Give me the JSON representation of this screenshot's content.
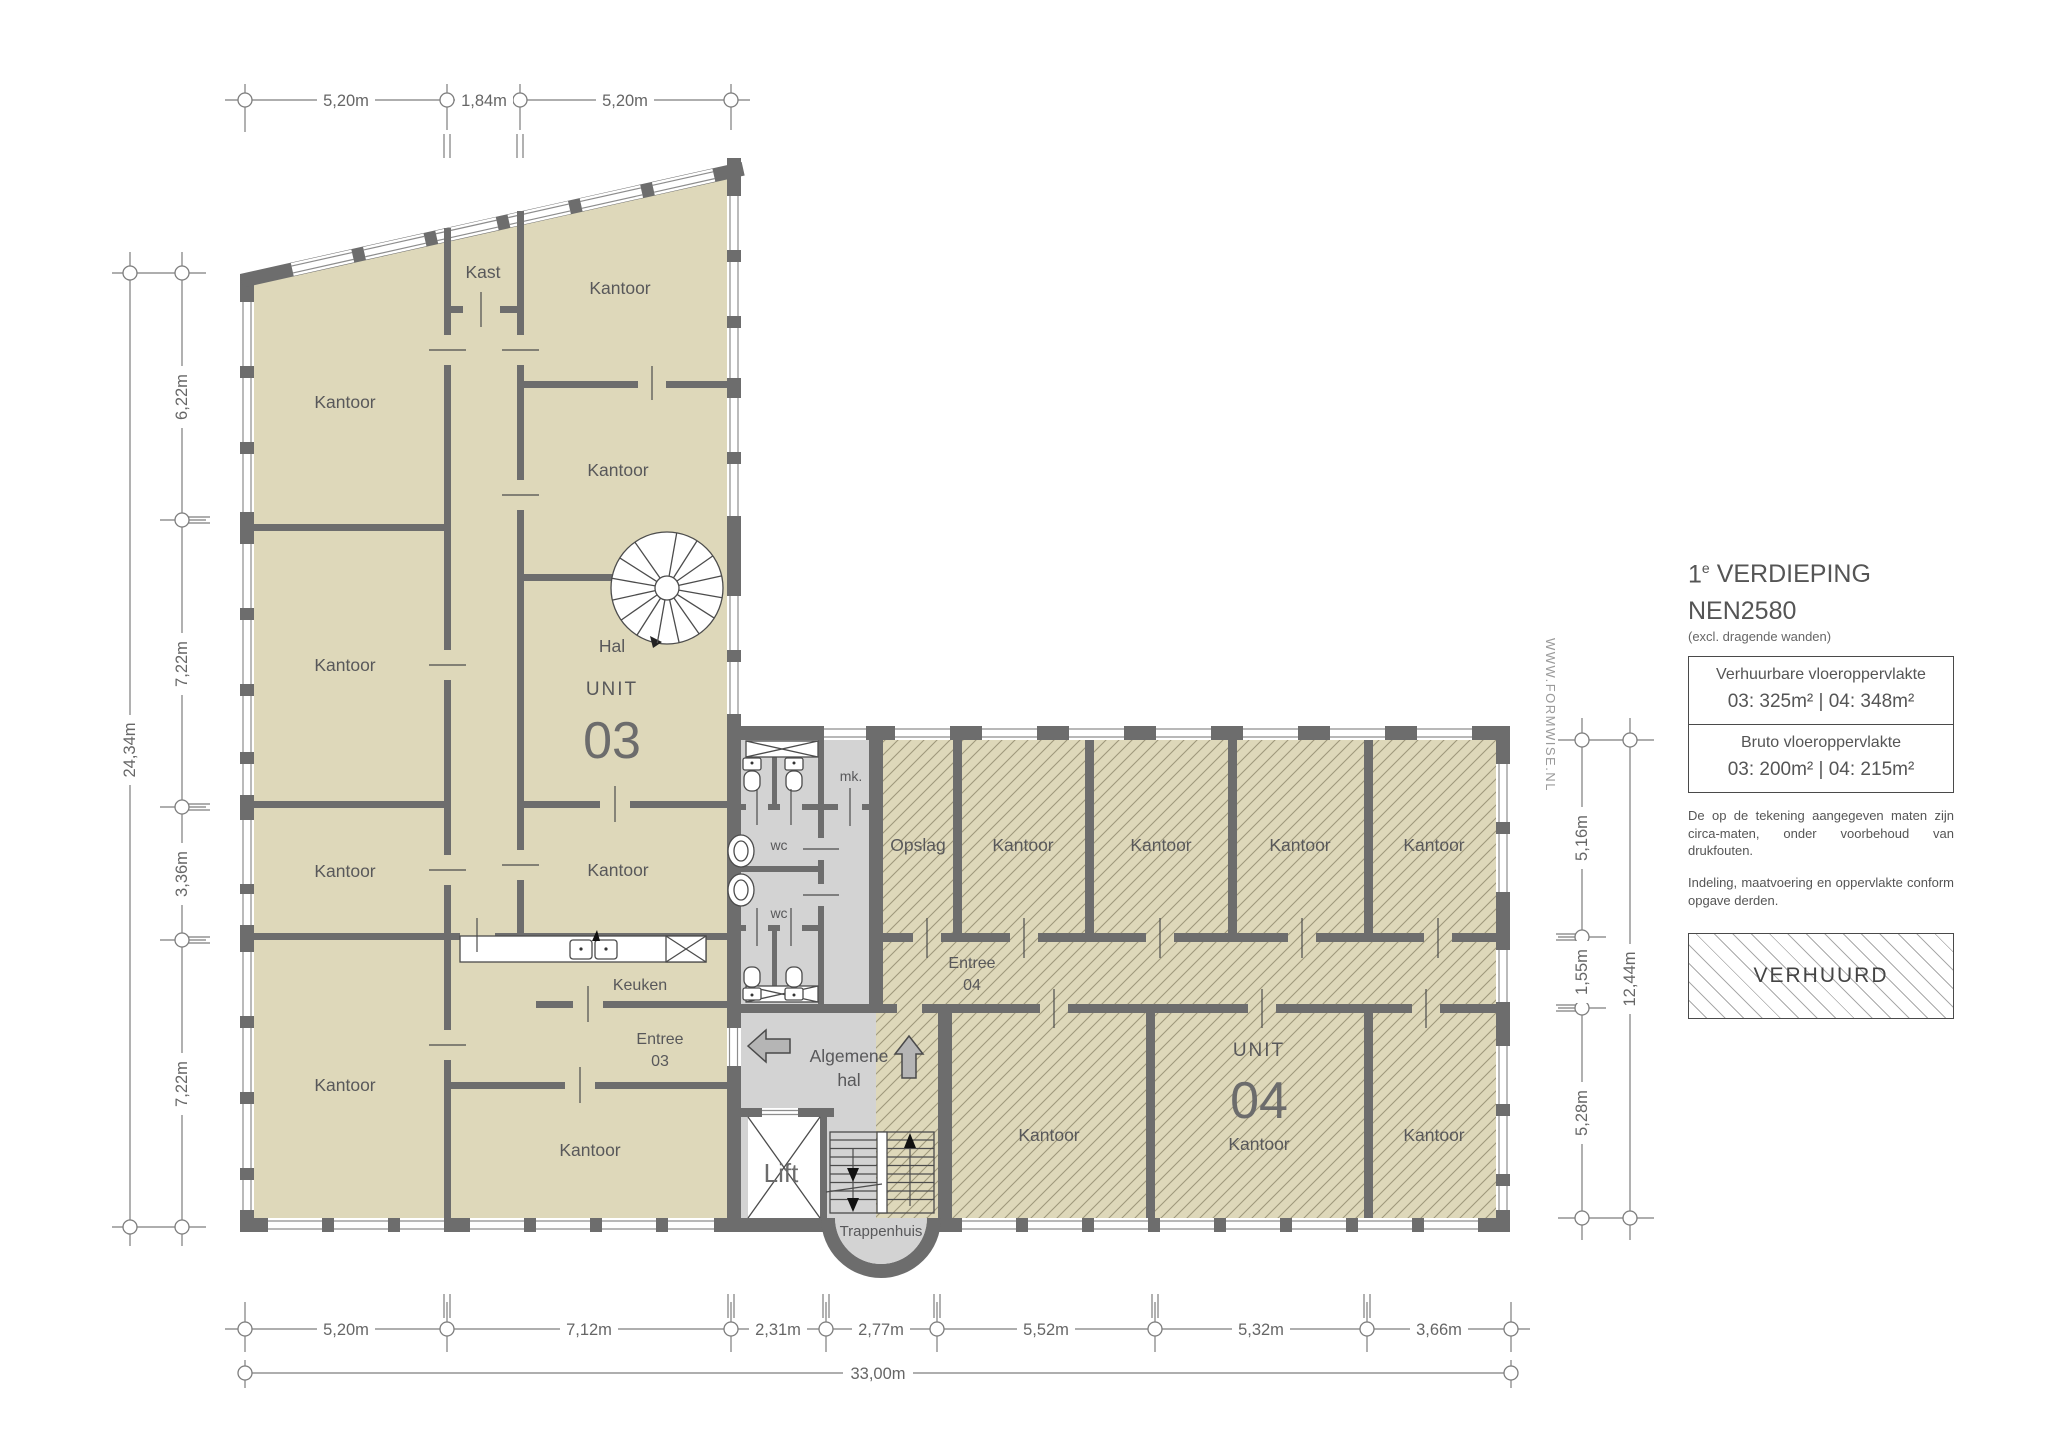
{
  "colors": {
    "wall": "#6d6d6d",
    "room": "#ded8ba",
    "corridor": "#d3d3d3",
    "hatch_line": "#8a8266",
    "label": "#58585a",
    "dim": "#7d7d7d",
    "dim_text": "#666666",
    "watermark": "#9a9a9a"
  },
  "watermark": "WWW.FORMWISE.NL",
  "rooms": {
    "kantoor": "Kantoor",
    "kast": "Kast",
    "hal": "Hal",
    "unit_label": "UNIT",
    "unit03_number": "03",
    "unit04_number": "04",
    "keuken": "Keuken",
    "entree": "Entree",
    "entree03_number": "03",
    "entree04_number": "04",
    "opslag": "Opslag",
    "mk": "mk.",
    "wc": "wc",
    "algemene": "Algemene",
    "algemene_hal": "hal",
    "lift": "Lift",
    "trappenhuis": "Trappenhuis"
  },
  "dims": {
    "top": [
      "5,20m",
      "1,84m",
      "5,20m"
    ],
    "left": [
      "6,22m",
      "7,22m",
      "3,36m",
      "7,22m"
    ],
    "left_total": "24,34m",
    "right": [
      "5,16m",
      "1,55m",
      "5,28m"
    ],
    "right_total": "12,44m",
    "bottom": [
      "5,20m",
      "7,12m",
      "2,31m",
      "2,77m",
      "5,52m",
      "5,32m",
      "3,66m"
    ],
    "bottom_total": "33,00m"
  },
  "legend": {
    "floor_prefix": "1",
    "floor_sup": "e",
    "floor_word": "VERDIEPING",
    "norm": "NEN2580",
    "norm_note": "(excl. dragende wanden)",
    "rentable_label": "Verhuurbare vloeroppervlakte",
    "rentable_values": "03: 325m² | 04: 348m²",
    "gross_label": "Bruto vloeroppervlakte",
    "gross_values": "03: 200m² | 04: 215m²",
    "note1": "De op de tekening aangegeven maten zijn circa-maten, onder voorbehoud van drukfouten.",
    "note2": "Indeling, maatvoering en oppervlakte conform opgave derden.",
    "verhuurd": "VERHUURD"
  }
}
